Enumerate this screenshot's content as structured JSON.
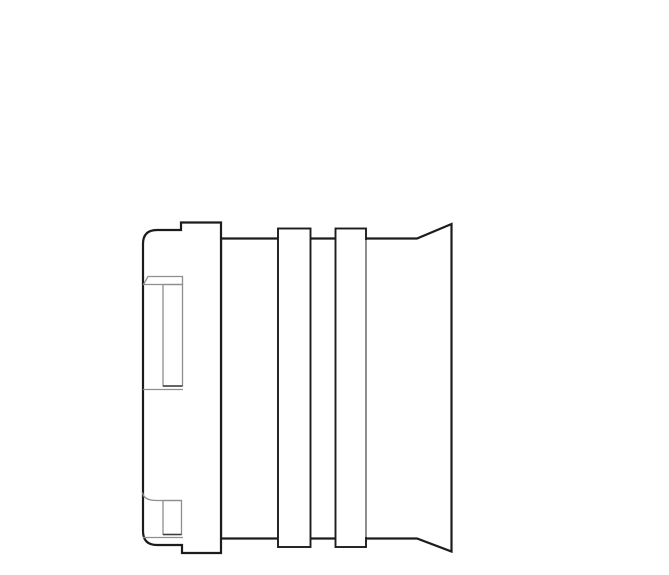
{
  "canvas": {
    "width": 669,
    "height": 575,
    "background": "#ffffff"
  },
  "colors": {
    "outline_dark": "#1c1c1c",
    "detail_gray": "#8e8e8e",
    "detail_dark": "#3c3c3c",
    "fill_white": "#ffffff"
  },
  "figure": {
    "kind": "technical-line-drawing",
    "subject": "connector-side-view"
  },
  "drawing": {
    "shapes": [
      {
        "name": "body-and-flare-outline",
        "type": "path",
        "d": "M221 238.5 H417 L451.5 224 V551.5 L417 538.5 H221 Z",
        "stroke": "outline_dark",
        "strokeWidth": 2.2,
        "fill": "fill_white"
      },
      {
        "name": "rib-1",
        "type": "rect",
        "x": 278,
        "y": 228.5,
        "width": 32.5,
        "height": 318.5,
        "stroke": "outline_dark",
        "strokeWidth": 1.9,
        "fill": "fill_white"
      },
      {
        "name": "rib-2",
        "type": "rect",
        "x": 335.5,
        "y": 228.5,
        "width": 30.5,
        "height": 318.5,
        "stroke": "outline_dark",
        "strokeWidth": 1.9,
        "fill": "fill_white"
      },
      {
        "name": "rib-2-tangent-edge",
        "type": "line",
        "x1": 366,
        "y1": 240,
        "x2": 366,
        "y2": 537,
        "stroke": "detail_gray",
        "strokeWidth": 2
      },
      {
        "name": "cap-block-outline",
        "type": "path",
        "d": "M181 222.5 H221 V553 H182 V545 H157 Q143 545 143 531 V244 Q143 230 157 230 H181 Z",
        "stroke": "outline_dark",
        "strokeWidth": 2.2,
        "fill": "fill_white"
      },
      {
        "name": "top-latch-band",
        "type": "path",
        "d": "M148 276.5 H182.5 V284.5 H143.5 Z",
        "stroke": "detail_gray",
        "strokeWidth": 1.3,
        "fill": "none"
      },
      {
        "name": "top-latch-slot",
        "type": "rect",
        "x": 163,
        "y": 284.5,
        "width": 19.5,
        "height": 101.5,
        "stroke": "detail_gray",
        "strokeWidth": 1.3,
        "fill": "none"
      },
      {
        "name": "top-latch-slot-bottom-edge",
        "type": "line",
        "x1": 163,
        "y1": 386,
        "x2": 182.5,
        "y2": 386,
        "stroke": "detail_dark",
        "strokeWidth": 1.5
      },
      {
        "name": "top-latch-base-edge",
        "type": "line",
        "x1": 143,
        "y1": 389.5,
        "x2": 183,
        "y2": 389.5,
        "stroke": "detail_gray",
        "strokeWidth": 1.3
      },
      {
        "name": "bottom-latch-curve",
        "type": "path",
        "d": "M142.5 492.5 Q143.5 500.5 157 500.5 H181.5",
        "stroke": "detail_gray",
        "strokeWidth": 1.3,
        "fill": "none"
      },
      {
        "name": "bottom-latch-slot",
        "type": "rect",
        "x": 163,
        "y": 500.5,
        "width": 18.5,
        "height": 34,
        "stroke": "detail_gray",
        "strokeWidth": 1.3,
        "fill": "none"
      },
      {
        "name": "bottom-latch-slot-bottom-edge",
        "type": "line",
        "x1": 163,
        "y1": 534.5,
        "x2": 181.5,
        "y2": 534.5,
        "stroke": "detail_dark",
        "strokeWidth": 1.5
      },
      {
        "name": "bottom-latch-base-edge",
        "type": "line",
        "x1": 143,
        "y1": 537.5,
        "x2": 183,
        "y2": 537.5,
        "stroke": "detail_gray",
        "strokeWidth": 1.3
      }
    ]
  }
}
